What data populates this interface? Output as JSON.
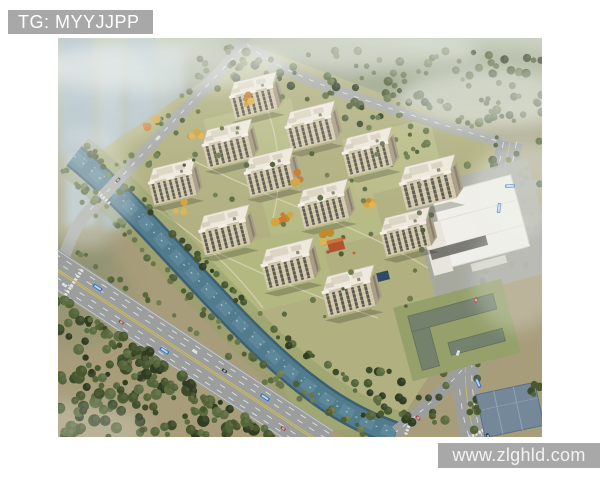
{
  "watermarks": {
    "top": {
      "label": "TG: MYYJJPP"
    },
    "bottom": {
      "label": "www.zlghld.com"
    }
  },
  "colors": {
    "page-bg": "#ffffff",
    "watermark-bg": "#a8a8a8",
    "watermark-top-text": "#ffffff",
    "watermark-bottom-text": "#f2f2f2"
  }
}
